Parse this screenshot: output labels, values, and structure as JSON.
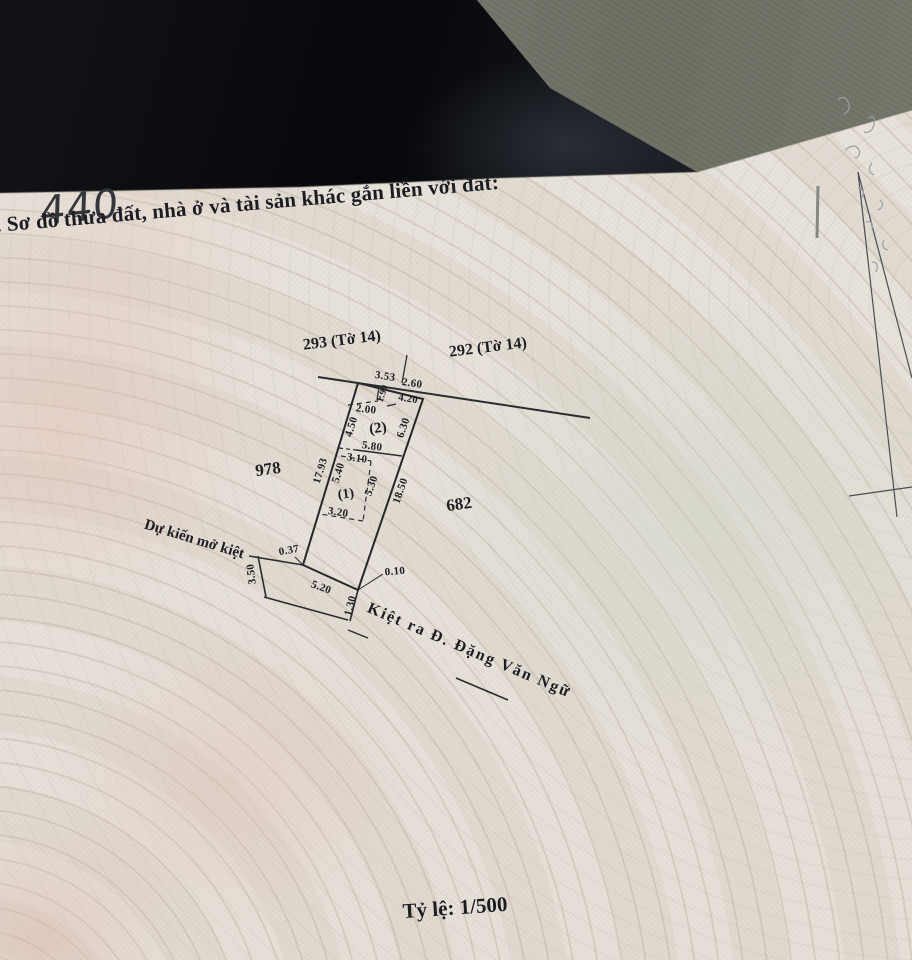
{
  "colors": {
    "paper": "#e7e3dc",
    "fabric": "#0c0e11",
    "floor": "#777a6e",
    "ink": "#1c1d22"
  },
  "document": {
    "handwritten_number": "440",
    "section_heading": ". Sơ đồ thửa đất, nhà ở và tài sản khác gắn liền với đất:",
    "scale_label": "Tỷ lệ: 1/500"
  },
  "diagram": {
    "adjacent_plots": {
      "top_left": "293 (Tờ 14)",
      "top_right": "292 (Tờ 14)",
      "left": "978",
      "right": "682"
    },
    "subplots": {
      "one": "(1)",
      "two": "(2)"
    },
    "annotations": {
      "planned_alley": "Dự kiến mở kiệt",
      "alley_to_street": "Kiệt ra Đ. Đặng Văn Ngữ"
    },
    "measurements": {
      "top_seg_a": "3.53",
      "top_seg_b": "2.60",
      "setback_depth": "1.90",
      "top_edge": "4.20",
      "setback_width": "2.00",
      "left_upper": "4.50",
      "right_upper": "6.30",
      "mid_width": "5.80",
      "inner_width": "3.10",
      "left_mid": "5.40",
      "left_total": "17.93",
      "inner_height": "5.30",
      "right_total": "18.50",
      "inner_bottom": "3.20",
      "corner_offset_left": "0.37",
      "alley_width": "3.50",
      "bottom_edge": "5.20",
      "corner_offset_right": "0.10",
      "alley_cross": "1.30"
    }
  }
}
